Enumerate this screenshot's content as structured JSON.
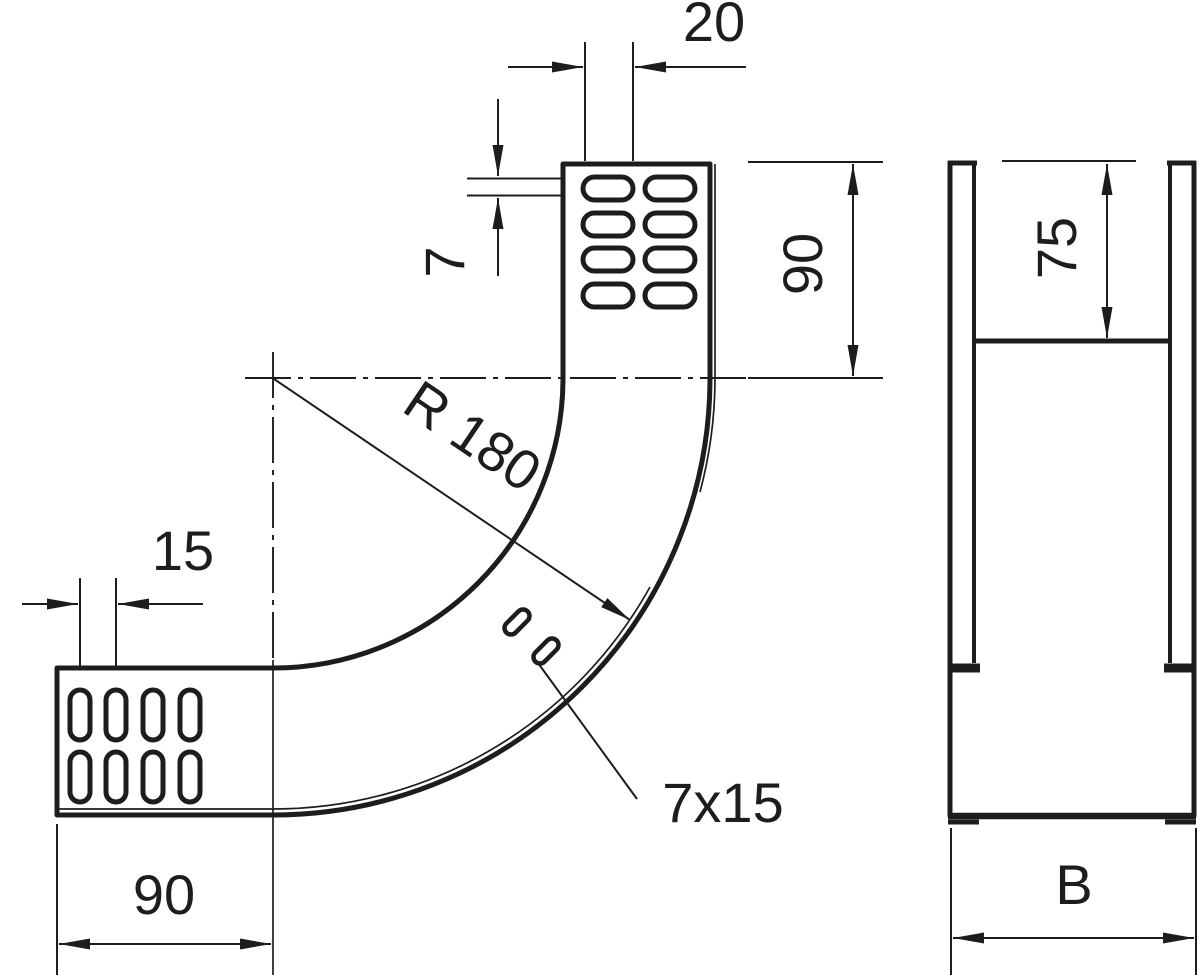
{
  "drawing": {
    "background_color": "#ffffff",
    "line_color": "#1d1d1b",
    "front_view": {
      "dim_slot_length_top": "20",
      "dim_slot_width": "7",
      "dim_vertical_leg": "90",
      "dim_slot_pitch": "15",
      "dim_bend_radius": "R 180",
      "dim_slot_size": "7x15",
      "dim_horizontal_leg": "90"
    },
    "side_view": {
      "dim_side_rail_height": "75",
      "dim_width": "B"
    }
  }
}
